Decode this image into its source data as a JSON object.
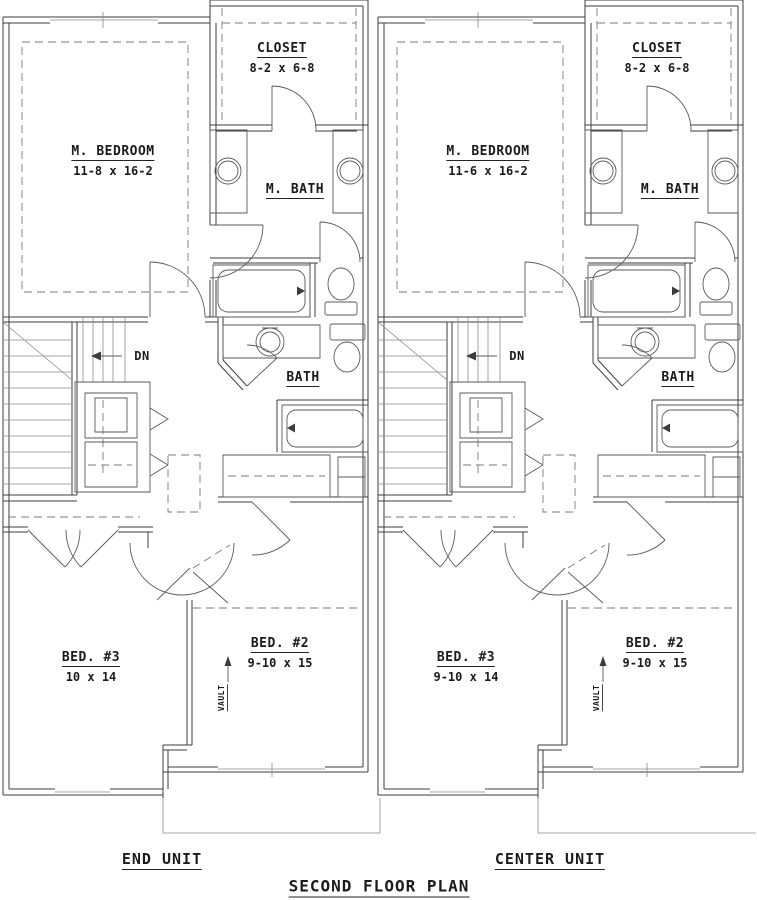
{
  "plan_title": "SECOND FLOOR PLAN",
  "units": [
    {
      "name": "END UNIT",
      "m_bedroom_label": "M. BEDROOM",
      "m_bedroom_dims": "11-8 x 16-2",
      "closet_label": "CLOSET",
      "closet_dims": "8-2 x 6-8",
      "m_bath_label": "M. BATH",
      "bath_label": "BATH",
      "bed2_label": "BED. #2",
      "bed2_dims": "9-10 x 15",
      "bed3_label": "BED. #3",
      "bed3_dims": "10 x 14",
      "stair_label": "DN",
      "vault_label": "VAULT"
    },
    {
      "name": "CENTER UNIT",
      "m_bedroom_label": "M. BEDROOM",
      "m_bedroom_dims": "11-6 x 16-2",
      "closet_label": "CLOSET",
      "closet_dims": "8-2 x 6-8",
      "m_bath_label": "M. BATH",
      "bath_label": "BATH",
      "bed2_label": "BED. #2",
      "bed2_dims": "9-10 x 15",
      "bed3_label": "BED. #3",
      "bed3_dims": "9-10 x 14",
      "stair_label": "DN",
      "vault_label": "VAULT"
    }
  ],
  "colors": {
    "wall": "#3d3d3d",
    "thin_line": "#8a8a8a",
    "fixture": "#5a5a5a",
    "dashed": "#7a7a7a",
    "text": "#1b1b1b",
    "background": "#ffffff"
  }
}
